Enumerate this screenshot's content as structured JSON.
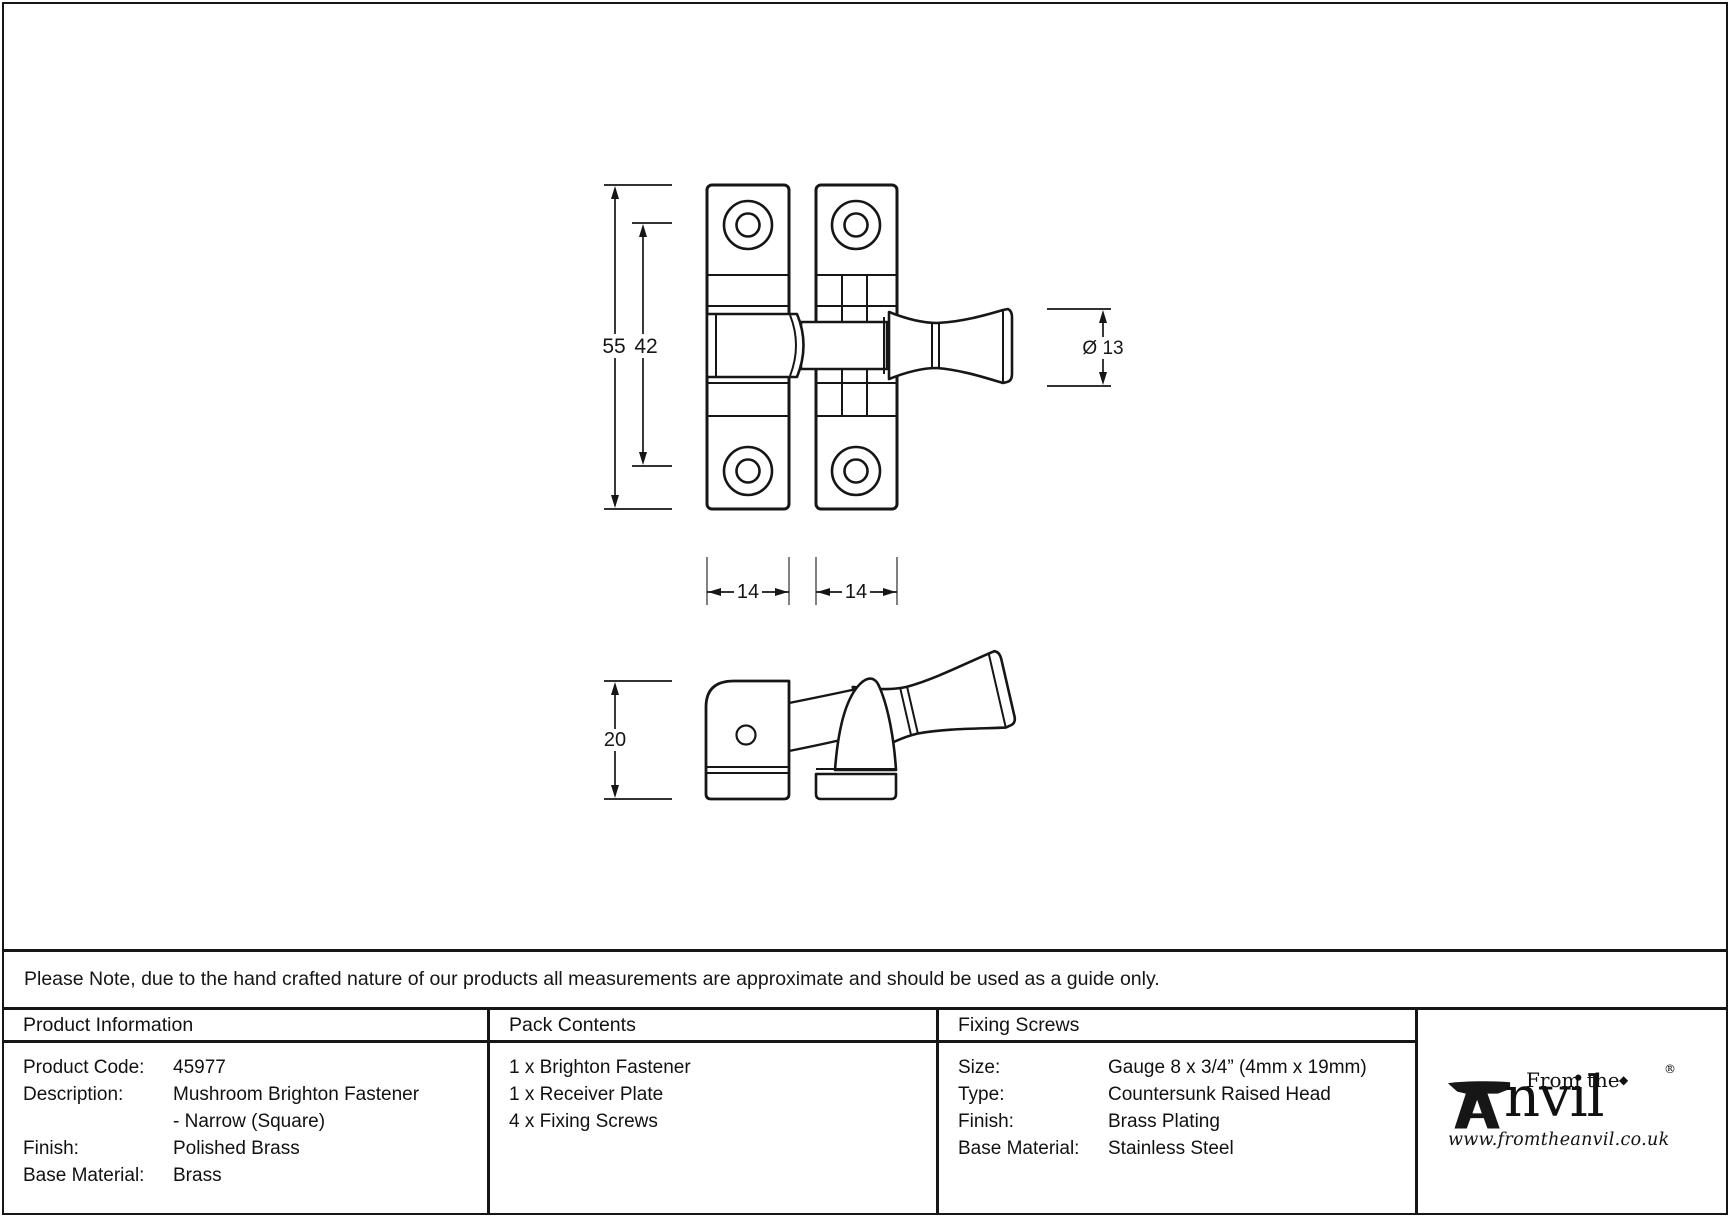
{
  "drawing": {
    "dims": {
      "overall_height": "55",
      "hole_spacing": "42",
      "knob_diameter": "Ø 13",
      "plate_width_left": "14",
      "plate_width_right": "14",
      "side_depth": "20"
    }
  },
  "note": "Please Note, due to the hand crafted nature of our products all measurements are approximate and should be used as a guide only.",
  "table": {
    "product_information": {
      "header": "Product Information",
      "rows": [
        {
          "label": "Product Code:",
          "value": "45977"
        },
        {
          "label": "Description:",
          "value": "Mushroom Brighton Fastener"
        },
        {
          "label": "",
          "value": "- Narrow (Square)"
        },
        {
          "label": "Finish:",
          "value": "Polished Brass"
        },
        {
          "label": "Base Material:",
          "value": "Brass"
        }
      ]
    },
    "pack_contents": {
      "header": "Pack Contents",
      "items": [
        "1 x Brighton Fastener",
        "1 x Receiver Plate",
        "4 x Fixing Screws"
      ]
    },
    "fixing_screws": {
      "header": "Fixing Screws",
      "rows": [
        {
          "label": "Size:",
          "value": "Gauge 8 x 3/4” (4mm x 19mm)"
        },
        {
          "label": "Type:",
          "value": "Countersunk Raised Head"
        },
        {
          "label": "Finish:",
          "value": "Brass Plating"
        },
        {
          "label": "Base Material:",
          "value": "Stainless Steel"
        }
      ]
    }
  },
  "logo": {
    "from_the": "From the",
    "anvil_word": "nvil",
    "diamond": "◆",
    "registered": "®",
    "website": "www.fromtheanvil.co.uk"
  }
}
